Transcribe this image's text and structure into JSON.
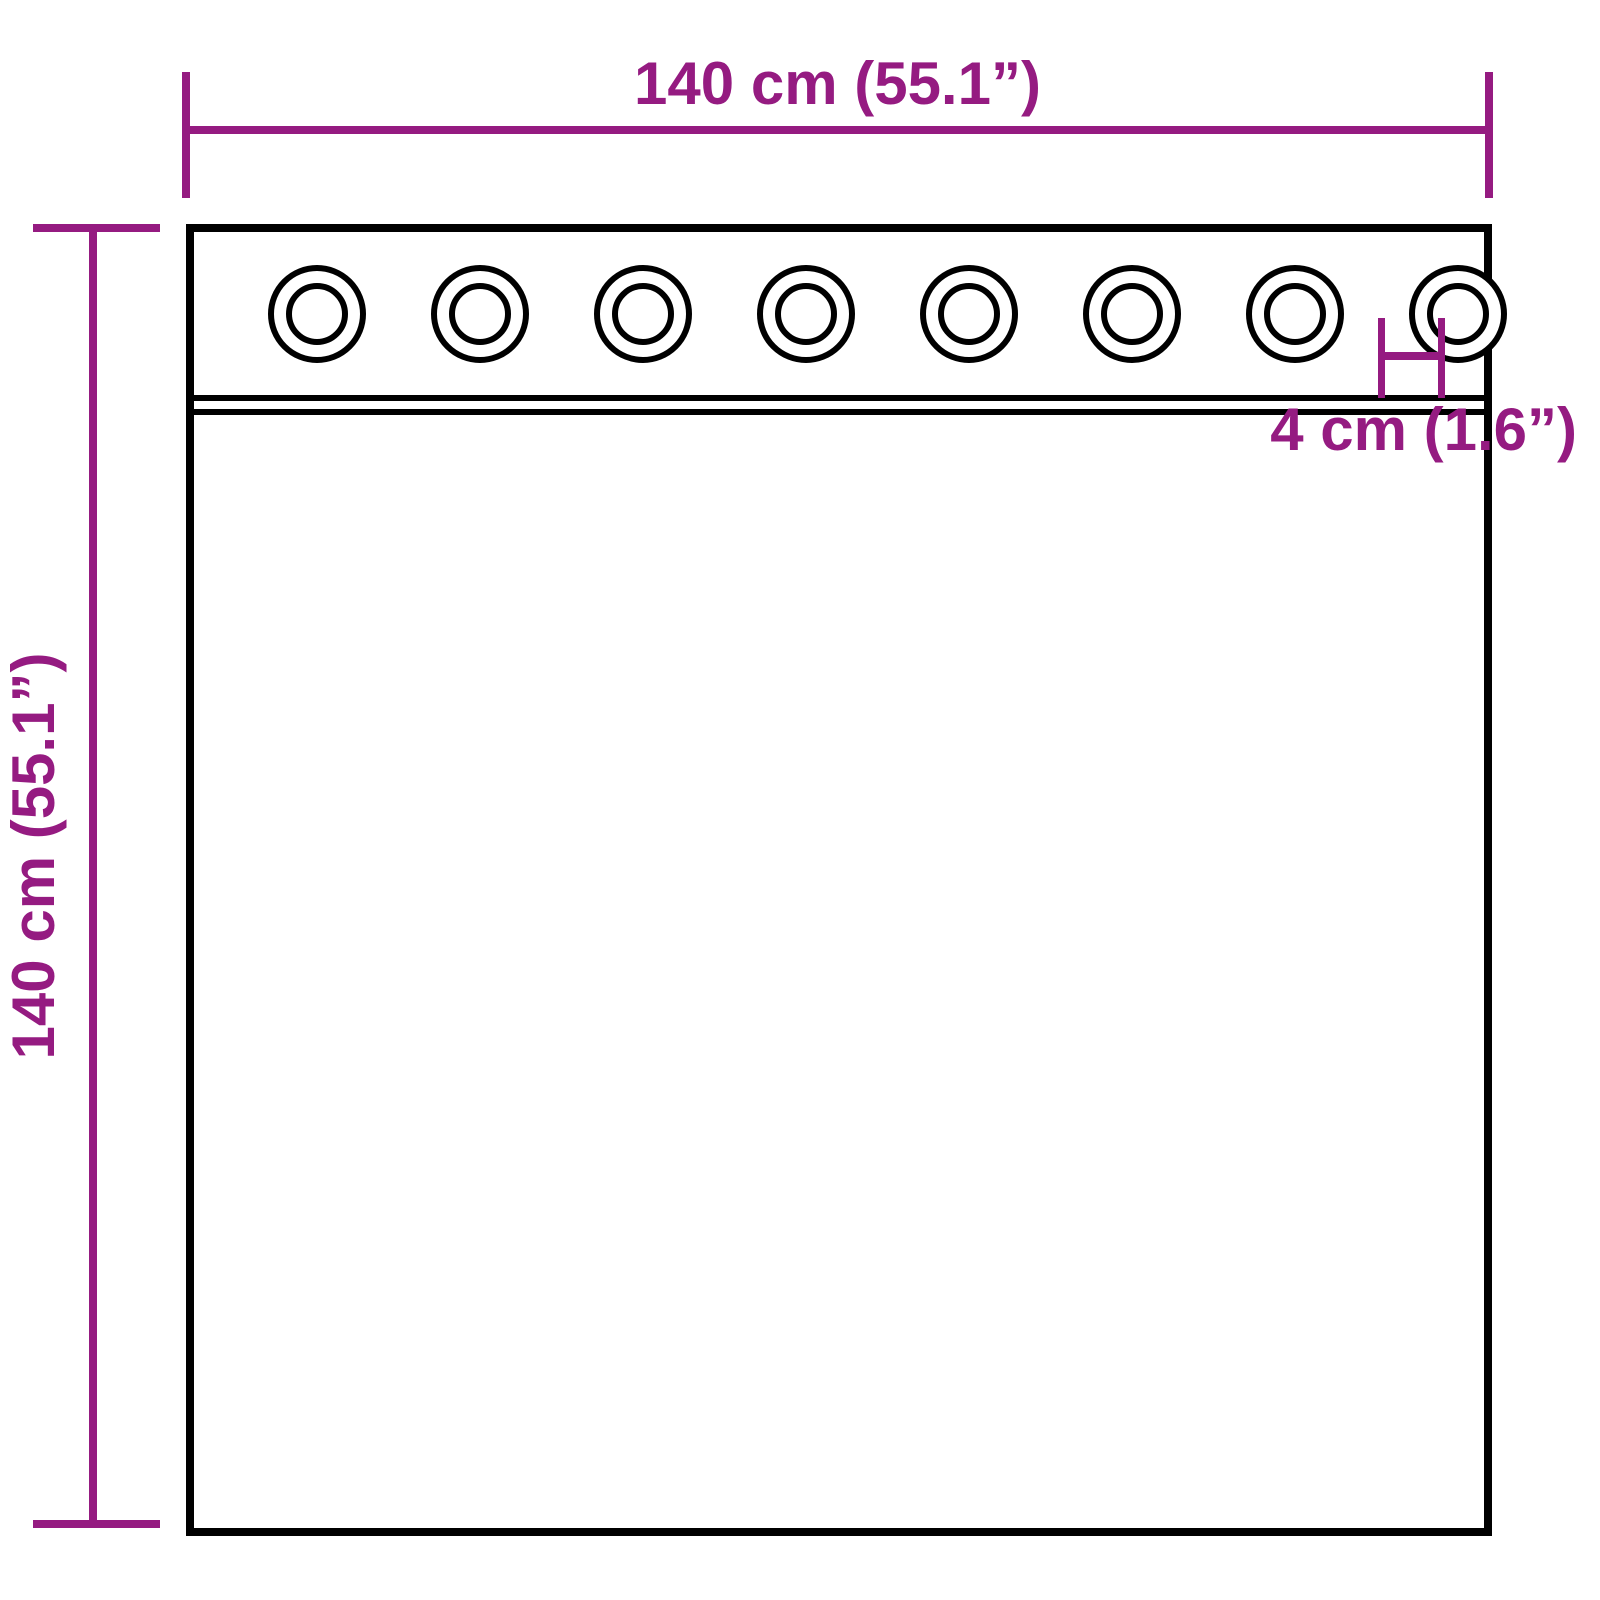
{
  "dimensions": {
    "width_label": "140 cm (55.1”)",
    "height_label": "140 cm (55.1”)",
    "grommet_hole_label": "4 cm (1.6”)"
  },
  "grommets": {
    "count": 8
  },
  "colors": {
    "dimension_accent": "#951b81",
    "outline": "#000000",
    "background": "#ffffff"
  }
}
